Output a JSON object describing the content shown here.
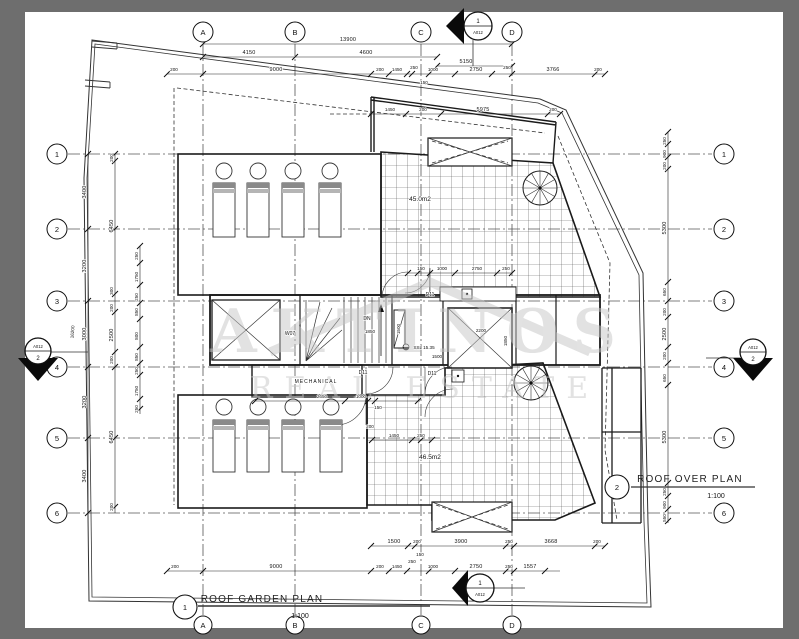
{
  "titles": {
    "garden": {
      "name": "ROOF GARDEN PLAN",
      "scale": "1:100",
      "num": "1"
    },
    "over": {
      "name": "ROOF OVER PLAN",
      "scale": "1:100",
      "num": "2"
    }
  },
  "grid": {
    "cols": [
      "A",
      "B",
      "C",
      "D"
    ],
    "rows": [
      "1",
      "2",
      "3",
      "4",
      "5",
      "6"
    ]
  },
  "markers": {
    "top": {
      "num": "1",
      "sheet": "A012"
    },
    "bottom": {
      "num": "1",
      "sheet": "A012"
    },
    "left": {
      "num": "2",
      "sheet": "A012"
    },
    "right": {
      "num": "2",
      "sheet": "A012"
    }
  },
  "dims": {
    "top": {
      "total": "13900",
      "seg": [
        "4150",
        "4600",
        "5150"
      ],
      "chain": [
        "200",
        "9000",
        "200",
        "1450",
        "250",
        "1000",
        "2750",
        "250",
        "3766",
        "200"
      ],
      "small": "150",
      "roof": [
        "1450",
        "200",
        "5975",
        "200"
      ]
    },
    "bottom": {
      "chain1": [
        "1500",
        "200",
        "3900",
        "250",
        "3668",
        "200"
      ],
      "small": [
        "150",
        "250"
      ],
      "chain2": [
        "200",
        "9000",
        "200",
        "1450",
        "1000",
        "2750",
        "250",
        "1557"
      ]
    },
    "left": {
      "outer": [
        "3400",
        "3200",
        "3000",
        "3200",
        "3400"
      ],
      "boundary": "16200",
      "mid": [
        "200",
        "6450",
        "300",
        "200",
        "2500",
        "200",
        "6450",
        "200"
      ],
      "inner": [
        "250",
        "1750",
        "250",
        "850",
        "800",
        "850",
        "250",
        "1750",
        "250"
      ]
    },
    "right": {
      "chain": [
        "250",
        "900",
        "200",
        "5300",
        "650",
        "200",
        "2500",
        "200",
        "650",
        "5300",
        "250",
        "900",
        "550"
      ]
    },
    "inner": {
      "top_chain": [
        "150",
        "1000",
        "2750",
        "250"
      ],
      "lower_chain": [
        "2650",
        "1000",
        "150",
        "200",
        "1450",
        "250"
      ],
      "stair": [
        "1850",
        "1500",
        "1500",
        "2200",
        "1850"
      ]
    }
  },
  "labels": {
    "mechanical": "MECHANICAL",
    "area_upper": "45.0m2",
    "area_lower": "46.5m2",
    "window": "W07",
    "door_a": "D11",
    "door_b": "D11",
    "door_c": "D11",
    "down": "DN",
    "level": "SSL 15.35"
  },
  "watermark": {
    "line1": "AKTINOS",
    "line2": "REAL ESTATE"
  }
}
